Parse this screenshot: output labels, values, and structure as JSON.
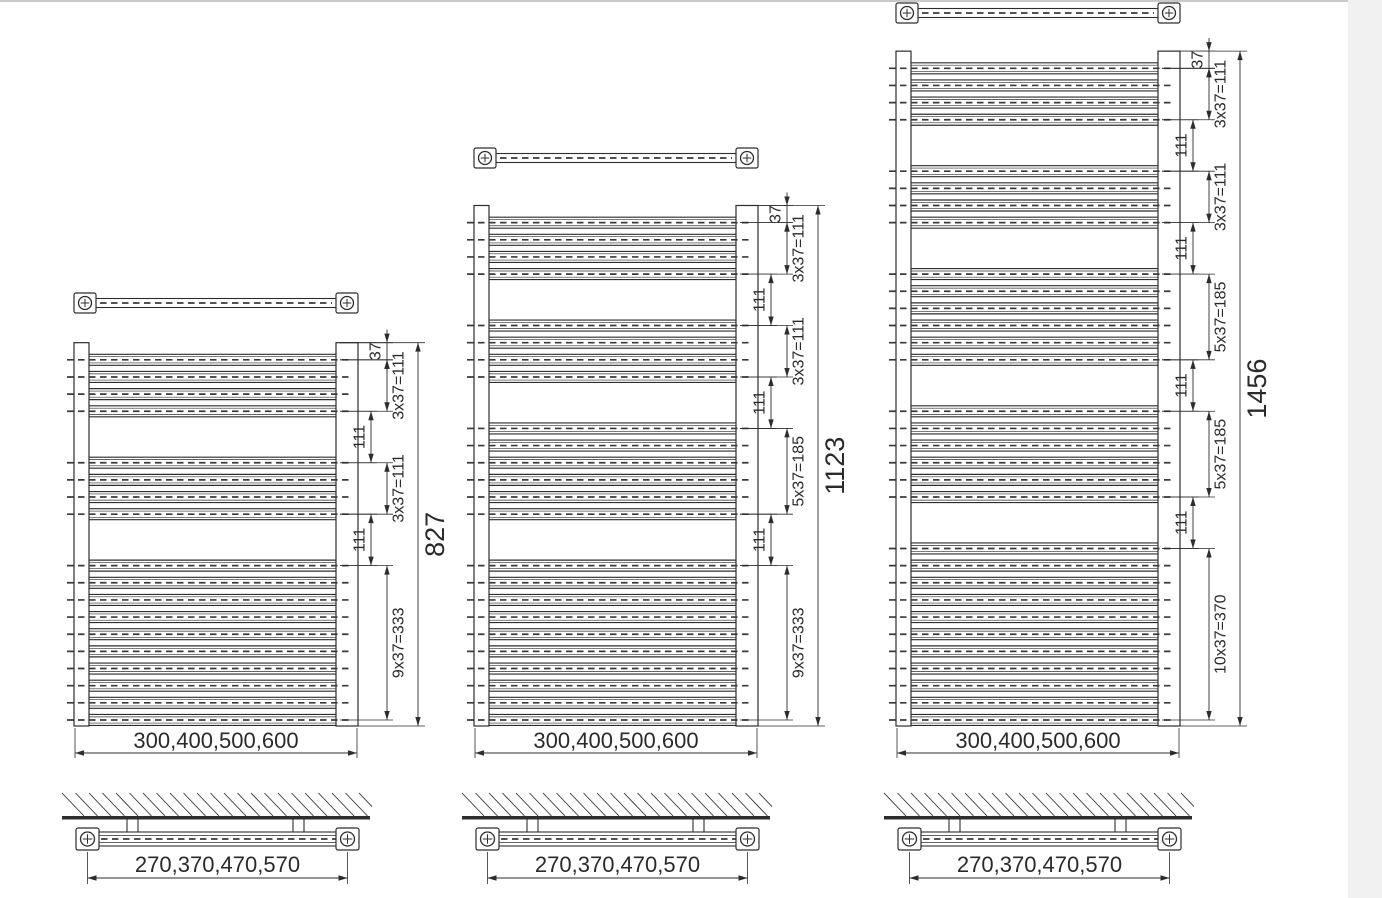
{
  "drawing": {
    "canvas": {
      "width": 1382,
      "height": 898
    },
    "colors": {
      "line": "#2d2d2d",
      "dash": "#3a3a3a",
      "text": "#2a2a2a",
      "background": "#ffffff",
      "scan_edge_top": "#c9c9c9",
      "scan_edge_right": "#f1f1f1"
    },
    "scale_px_per_mm": 0.4635,
    "baseline_y": 726,
    "tube_pitch_mm": 37,
    "wall_section": {
      "band_top_y": 793,
      "band_bottom_y": 816,
      "thick_line_height": 3.5,
      "stem_bottom_y": 832,
      "tube_top_y": 832,
      "tube_height": 14,
      "cap_top_y": 828,
      "cap_height": 22,
      "dim_line_y": 878,
      "label_y": 872
    },
    "radiators": [
      {
        "name": "small-radiator",
        "x": 74,
        "body_width": 284,
        "height_mm": 827,
        "top_bar_center_y": 303,
        "first_tube_mm": 37,
        "group_gap_mm": 111,
        "tube_groups": [
          4,
          4,
          10
        ],
        "total_label": "827",
        "width_label": "300,400,500,600",
        "bracket_label": "270,370,470,570",
        "dims": [
          {
            "from_mm": 0,
            "to_mm": 37,
            "label": "37",
            "col": "outer",
            "side": "left"
          },
          {
            "from_mm": 37,
            "to_mm": 148,
            "label": "3x37=111",
            "col": "outer",
            "side": "right"
          },
          {
            "from_mm": 148,
            "to_mm": 259,
            "label": "111",
            "col": "inner",
            "side": "left"
          },
          {
            "from_mm": 259,
            "to_mm": 370,
            "label": "3x37=111",
            "col": "outer",
            "side": "right"
          },
          {
            "from_mm": 370,
            "to_mm": 481,
            "label": "111",
            "col": "inner",
            "side": "left"
          },
          {
            "from_mm": 481,
            "to_mm": 814,
            "label": "9x37=333",
            "col": "outer",
            "side": "right"
          }
        ]
      },
      {
        "name": "medium-radiator",
        "x": 474,
        "body_width": 284,
        "height_mm": 1123,
        "top_bar_center_y": 158,
        "first_tube_mm": 37,
        "group_gap_mm": 111,
        "tube_groups": [
          4,
          4,
          6,
          10
        ],
        "total_label": "1123",
        "width_label": "300,400,500,600",
        "bracket_label": "270,370,470,570",
        "dims": [
          {
            "from_mm": 0,
            "to_mm": 37,
            "label": "37",
            "col": "outer",
            "side": "left"
          },
          {
            "from_mm": 37,
            "to_mm": 148,
            "label": "3x37=111",
            "col": "outer",
            "side": "right"
          },
          {
            "from_mm": 148,
            "to_mm": 259,
            "label": "111",
            "col": "inner",
            "side": "left"
          },
          {
            "from_mm": 259,
            "to_mm": 370,
            "label": "3x37=111",
            "col": "outer",
            "side": "right"
          },
          {
            "from_mm": 370,
            "to_mm": 481,
            "label": "111",
            "col": "inner",
            "side": "left"
          },
          {
            "from_mm": 481,
            "to_mm": 666,
            "label": "5x37=185",
            "col": "outer",
            "side": "right"
          },
          {
            "from_mm": 666,
            "to_mm": 777,
            "label": "111",
            "col": "inner",
            "side": "left"
          },
          {
            "from_mm": 777,
            "to_mm": 1110,
            "label": "9x37=333",
            "col": "outer",
            "side": "right"
          }
        ]
      },
      {
        "name": "large-radiator",
        "x": 896,
        "body_width": 284,
        "height_mm": 1456,
        "top_bar_center_y": 13,
        "first_tube_mm": 37,
        "group_gap_mm": 111,
        "tube_groups": [
          4,
          4,
          6,
          6,
          11
        ],
        "total_label": "1456",
        "width_label": "300,400,500,600",
        "bracket_label": "270,370,470,570",
        "dims": [
          {
            "from_mm": 0,
            "to_mm": 37,
            "label": "37",
            "col": "outer",
            "side": "left"
          },
          {
            "from_mm": 37,
            "to_mm": 148,
            "label": "3x37=111",
            "col": "outer",
            "side": "right"
          },
          {
            "from_mm": 148,
            "to_mm": 259,
            "label": "111",
            "col": "inner",
            "side": "left"
          },
          {
            "from_mm": 259,
            "to_mm": 370,
            "label": "3x37=111",
            "col": "outer",
            "side": "right"
          },
          {
            "from_mm": 370,
            "to_mm": 481,
            "label": "111",
            "col": "inner",
            "side": "left"
          },
          {
            "from_mm": 481,
            "to_mm": 666,
            "label": "5x37=185",
            "col": "outer",
            "side": "right"
          },
          {
            "from_mm": 666,
            "to_mm": 777,
            "label": "111",
            "col": "inner",
            "side": "left"
          },
          {
            "from_mm": 777,
            "to_mm": 962,
            "label": "5x37=185",
            "col": "outer",
            "side": "right"
          },
          {
            "from_mm": 962,
            "to_mm": 1073,
            "label": "111",
            "col": "inner",
            "side": "left"
          },
          {
            "from_mm": 1073,
            "to_mm": 1443,
            "label": "10x37=370",
            "col": "outer",
            "side": "right"
          }
        ]
      }
    ]
  }
}
